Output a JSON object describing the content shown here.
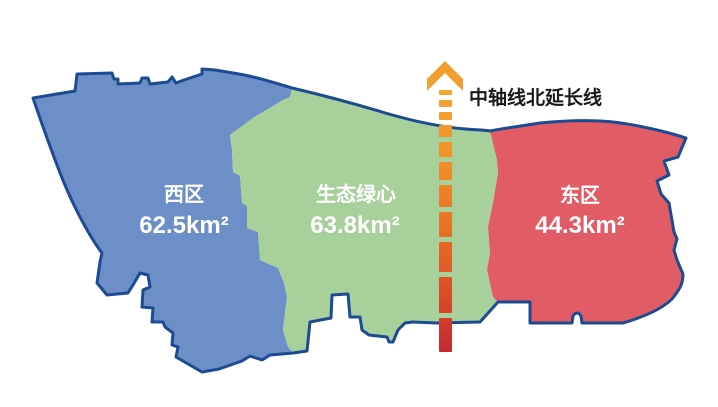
{
  "map": {
    "title": "district-area-map",
    "regions": [
      {
        "id": "west",
        "name": "西区",
        "area": "62.5km²"
      },
      {
        "id": "green-heart",
        "name": "生态绿心",
        "area": "63.8km²"
      },
      {
        "id": "east",
        "name": "东区",
        "area": "44.3km²"
      }
    ],
    "axis": {
      "label": "中轴线北延长线",
      "arrow_icon": "up-arrow-icon",
      "line_style": "dashed-gradient"
    }
  },
  "colors": {
    "west_fill": "#6d8fc7",
    "green_fill": "#a7d09a",
    "east_fill": "#e25c66",
    "outline": "#1c4b93",
    "label_text": "#ffffff",
    "axis_label_text": "#1a1a1a",
    "axis_arrow": "#f0a02f",
    "axis_gradient": [
      "#f3a52f",
      "#ef8f2b",
      "#e76e27",
      "#db4c29",
      "#c42a32"
    ]
  }
}
